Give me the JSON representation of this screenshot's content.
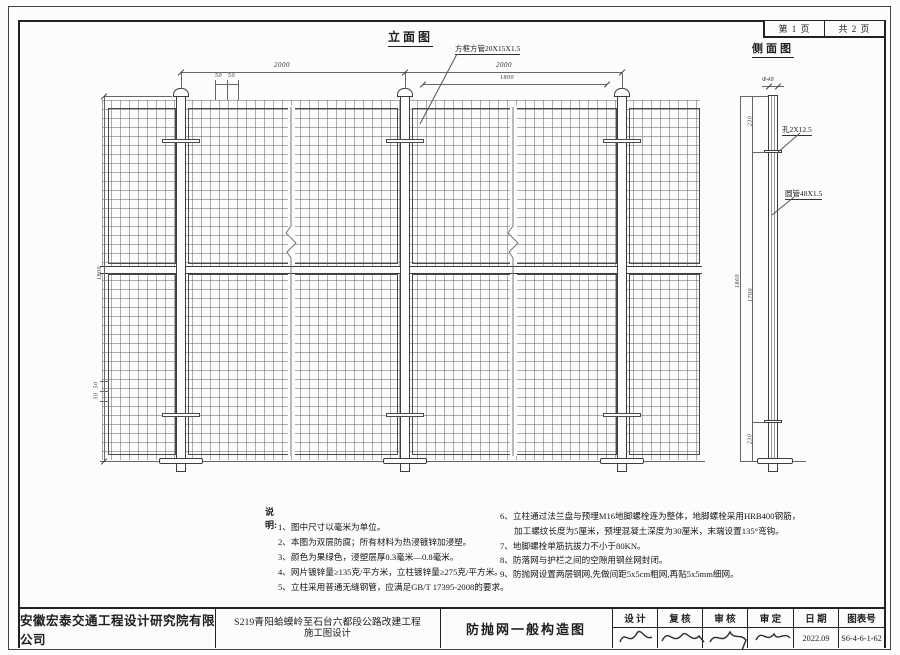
{
  "sheet": {
    "page_no": "第 1 页",
    "page_total": "共 2 页"
  },
  "views": {
    "elevation_title": "立面图",
    "side_title": "侧面图"
  },
  "elevation": {
    "frame_label": "方框方管20X15X1.5",
    "dim_span1": "2000",
    "dim_span2": "2000",
    "dim_inner": "1800",
    "dim_small_a": "50",
    "dim_small_b": "50",
    "dim_height": "1800",
    "dim_left_small_a": "50",
    "dim_left_small_b": "50"
  },
  "side": {
    "dim_dia": "Φ48",
    "hole_label": "孔2X12.5",
    "pipe_label": "圆管48X1.5",
    "dim_top": "230",
    "dim_total": "1860",
    "dim_mid": "1700",
    "dim_bottom": "230"
  },
  "notes": {
    "title": "说明:",
    "left": [
      "1、图中尺寸以毫米为单位。",
      "2、本图为双层防腐；所有材料为热浸镀锌加浸塑。",
      "3、颜色为果绿色，浸塑层厚0.3毫米—0.8毫米。",
      "4、网片镀锌量≥135克/平方米，立柱镀锌量≥275克/平方米。",
      "5、立柱采用普通无缝钢管，应满足GB/T 17395-2008的要求。"
    ],
    "right": [
      "6、立柱通过法兰盘与预埋M16地脚螺栓连为整体，地脚螺栓采用HRB400钢筋，",
      "加工螺纹长度为5厘米，预埋混凝土深度为30厘米，末端设置135°弯钩。",
      "7、地脚螺栓单筋抗拔力不小于80KN。",
      "8、防落网与护栏之间的空隙用钢丝网封闭。",
      "9、防抛网设置两层钢网,先做间距5x5cm粗网,再贴5x5mm细网。"
    ]
  },
  "titleblock": {
    "company": "安徽宏泰交通工程设计研究院有限公司",
    "project1": "S219青阳蛤蟆岭至石台六都段公路改建工程",
    "project2": "施工图设计",
    "drawing_title": "防抛网一般构造图",
    "fields": [
      "设 计",
      "复 核",
      "审 核",
      "审 定",
      "日 期",
      "图表号"
    ],
    "date": "2022.09",
    "sheet_no": "S6-4-6-1-62"
  }
}
